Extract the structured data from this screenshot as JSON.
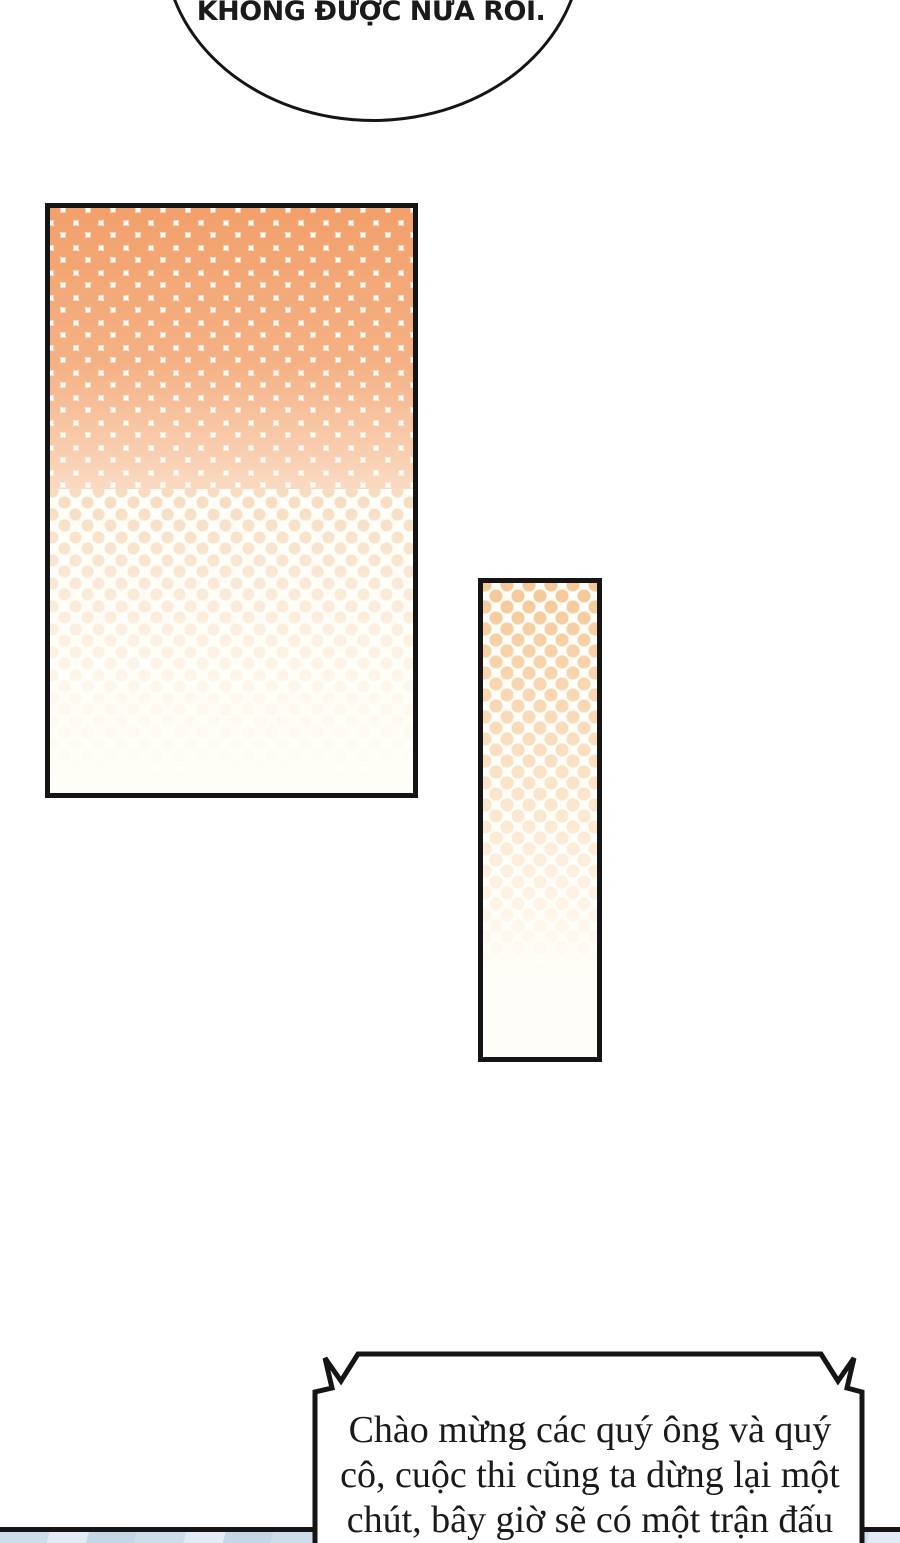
{
  "page": {
    "type": "comic-page",
    "background": "#ffffff"
  },
  "colors": {
    "ink": "#151515",
    "paper": "#fffdf7",
    "text": "#1a1a1a",
    "halftone_orange": "#f2a06b",
    "halftone_mid": "#efc193",
    "halftone_light": "#f5c897",
    "strip_blue": "#cddeeb",
    "strip_blue_light": "#e2ecf4",
    "strip_blue_dark": "#c3d7e6"
  },
  "speech_bubble": {
    "text": "KHÔNG ĐƯỢC NỮA RỒI."
  },
  "announcement": {
    "lines": [
      "Chào mừng các quý ông và quý",
      "cô, cuộc thi cũng ta dừng lại một",
      "chút, bây giờ sẽ có một trận đấu"
    ]
  }
}
